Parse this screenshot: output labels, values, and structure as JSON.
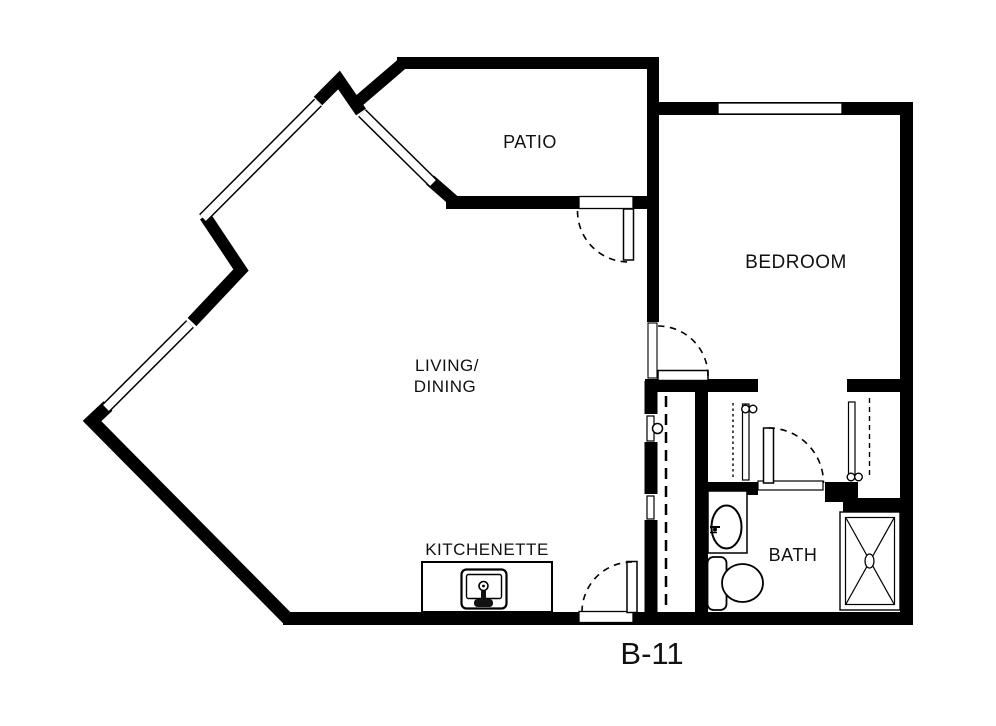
{
  "title": "Apartment floor plan",
  "unit": {
    "code": "B-11"
  },
  "rooms": {
    "patio": {
      "label": "PATIO"
    },
    "bedroom": {
      "label": "BEDROOM"
    },
    "living_dining": {
      "label_line1": "LIVING/",
      "label_line2": "DINING"
    },
    "kitchenette": {
      "label": "KITCHENETTE"
    },
    "bath": {
      "label": "BATH"
    }
  },
  "fixtures": {
    "kitchen_sink": "kitchen-sink",
    "bathroom_sink": "bathroom-vanity-sink",
    "toilet": "toilet",
    "shower": "shower-stall",
    "closet_rods": "closet-rod-lines",
    "doors": [
      "entry-door",
      "patio-door",
      "bedroom-door",
      "bath-door"
    ],
    "windows": [
      "nw-window",
      "sw-window",
      "patio-window",
      "bedroom-window"
    ]
  },
  "colors": {
    "wall": "#000000",
    "background": "#ffffff",
    "text": "#111111"
  }
}
